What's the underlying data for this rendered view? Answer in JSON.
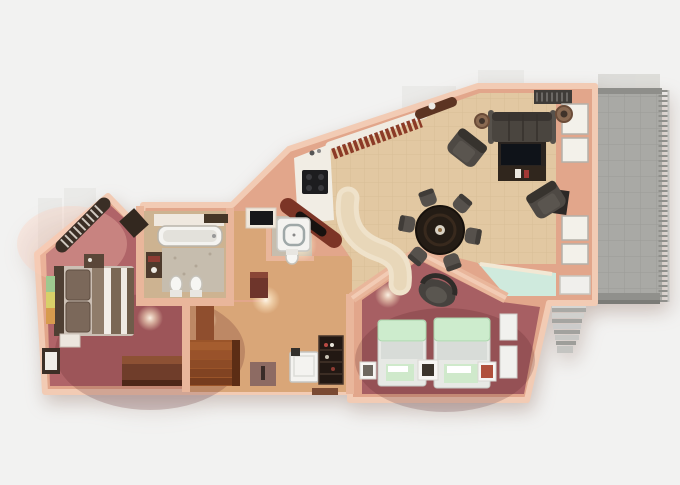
{
  "scene": {
    "description": "Bird's-eye 3D architectural render of a two-bedroom suite floor plan with wrap-around terrace, shown on a plain light background",
    "view": "top-down cutaway",
    "visible_text": ""
  },
  "palette": {
    "background": "#f2f2f1",
    "ghost_building": "#e9e9e7",
    "wall_face": "#e2a68b",
    "wall_top": "#f2cbb4",
    "wall_inner": "#e9b69b",
    "living_floor": "#e2c8a2",
    "tile_line": "#cdb189",
    "corridor_floor": "#d9a678",
    "master_floor": "#b06468",
    "twin_floor": "#a75f63",
    "bathroom_floor": "#cdb391",
    "marble": "#c6bdae",
    "teal_glass": "#cfeadd",
    "terrace": "#a9a9a5",
    "terrace_line": "#9a9a96",
    "sofa": "#4a453f",
    "armchair": "#4e4944",
    "dining_chair": "#56514c",
    "dining_table": "#241c15",
    "tv_console": "#2a2420",
    "bar_wood": "#8c3b27",
    "cabinet_wood": "#7c3526",
    "counter_white": "#f1ede4",
    "steps_wood": "#9a5429",
    "minibar": "#221813",
    "chest_wood": "#6f3d2a",
    "bed_brown": "#7b685a",
    "bed_white": "#f2eee8",
    "mint": "#cdeccd",
    "fixture_white": "#f4f3f0",
    "glow": "#ffedc9"
  },
  "rooms": [
    {
      "id": "living-dining",
      "label": "Living and dining room",
      "furniture": [
        "three-seat sofa",
        "two round side tables",
        "two armchairs",
        "tv console with coffee table",
        "round dining table",
        "six dining chairs",
        "curved bar island"
      ]
    },
    {
      "id": "kitchen",
      "label": "Kitchen",
      "furniture": [
        "breakfast bar with stools",
        "white counter with cooktop",
        "diagonal oven cabinet"
      ]
    },
    {
      "id": "master-bedroom",
      "label": "Master bedroom",
      "furniture": [
        "double bed with striped cover",
        "wardrobe rail",
        "nightstands",
        "wall art strip",
        "wooden storage chest",
        "floor mat"
      ]
    },
    {
      "id": "master-bathroom",
      "label": "Master bathroom",
      "furniture": [
        "bathtub",
        "marble floor",
        "toilet",
        "bidet",
        "dark vanity"
      ]
    },
    {
      "id": "guest-shower-room",
      "label": "Guest shower room",
      "furniture": [
        "square shower",
        "toilet",
        "black-top vanity desk"
      ]
    },
    {
      "id": "hallway",
      "label": "Entry hallway",
      "furniture": [
        "wooden steps",
        "minibar cabinet",
        "mini fridge",
        "console table"
      ]
    },
    {
      "id": "twin-bedroom",
      "label": "Twin bedroom",
      "furniture": [
        "two twin beds with mint bedding",
        "dark armchair",
        "three framed pictures",
        "window panels"
      ]
    },
    {
      "id": "terrace",
      "label": "Terrace",
      "furniture": [
        "tiled deck",
        "railing",
        "exterior stairs"
      ]
    }
  ]
}
